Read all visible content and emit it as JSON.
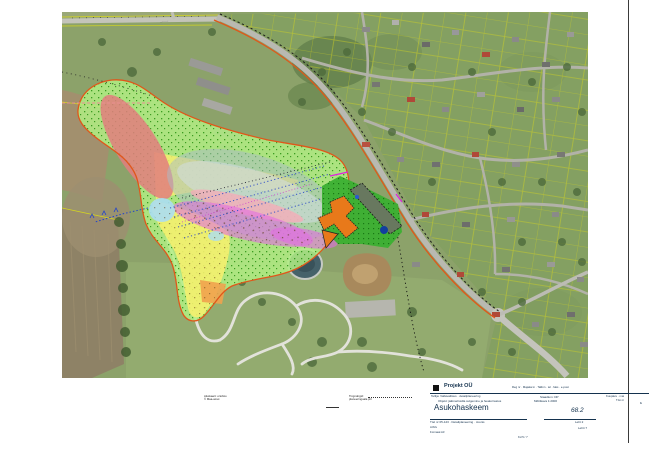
{
  "map": {
    "road_label": "··········",
    "zone_colors": {
      "overlay_green": "#b2ef84",
      "slope_red": "#e27e7e",
      "zone_yellow": "#f4ef6e",
      "terrace_gray": "#a9bcc8",
      "zone_magenta": "#e26ce2",
      "zone_pink": "#f4acb8",
      "zone_lightblue": "#abddf2",
      "zone_orange": "#f0a24e",
      "boundary_orange": "#e0571a",
      "site_green": "#3bb032",
      "building_orange": "#e8791a",
      "cadastral_yellow": "#d6d61e"
    },
    "base_colors": {
      "grass": "#8ca26a",
      "residential": "#84a062",
      "field_brown": "#8e8266",
      "road_gray": "#b9b9b1",
      "pond": "#46626a"
    }
  },
  "notes": {
    "source_line1": "Aluskaart: ortofoto",
    "source_line2": "© Maa-amet",
    "legend_line1": "Tingmärgid:",
    "legend_line2": "planeeringuala piir"
  },
  "title_block": {
    "company": "Projekt OÜ",
    "contact_info": "Reg nr · Majaka tn · Tallinn · tel · faks · e-post",
    "row2_left_l1": "Tellija: Vallavalitsus · detailplaneering",
    "row2_left_l2": "Objekt: jäätmehoidla sulgemine ja heakorrastus",
    "row2_mid_l1": "Staadium: DP",
    "row2_mid_l2": "Mõõtkava 1:2000",
    "row2_right_l1": "Kuupäev · mai",
    "row2_right_l2": "Töö nr",
    "row2_right_l3": "lk",
    "drawing_title": "Asukohaskeem",
    "sheet_number": "68.2",
    "row3_left_l1": "Töö nr 05-123 · Detailplaneering · Joonis",
    "row3_left_l2": "Arhiiv",
    "row3_left_l3": "Formaat A3",
    "row3_right_l1": "Leht 2",
    "row3_right_l2": "Lehti 7",
    "bottom_note": "Kd 5 / 7"
  }
}
